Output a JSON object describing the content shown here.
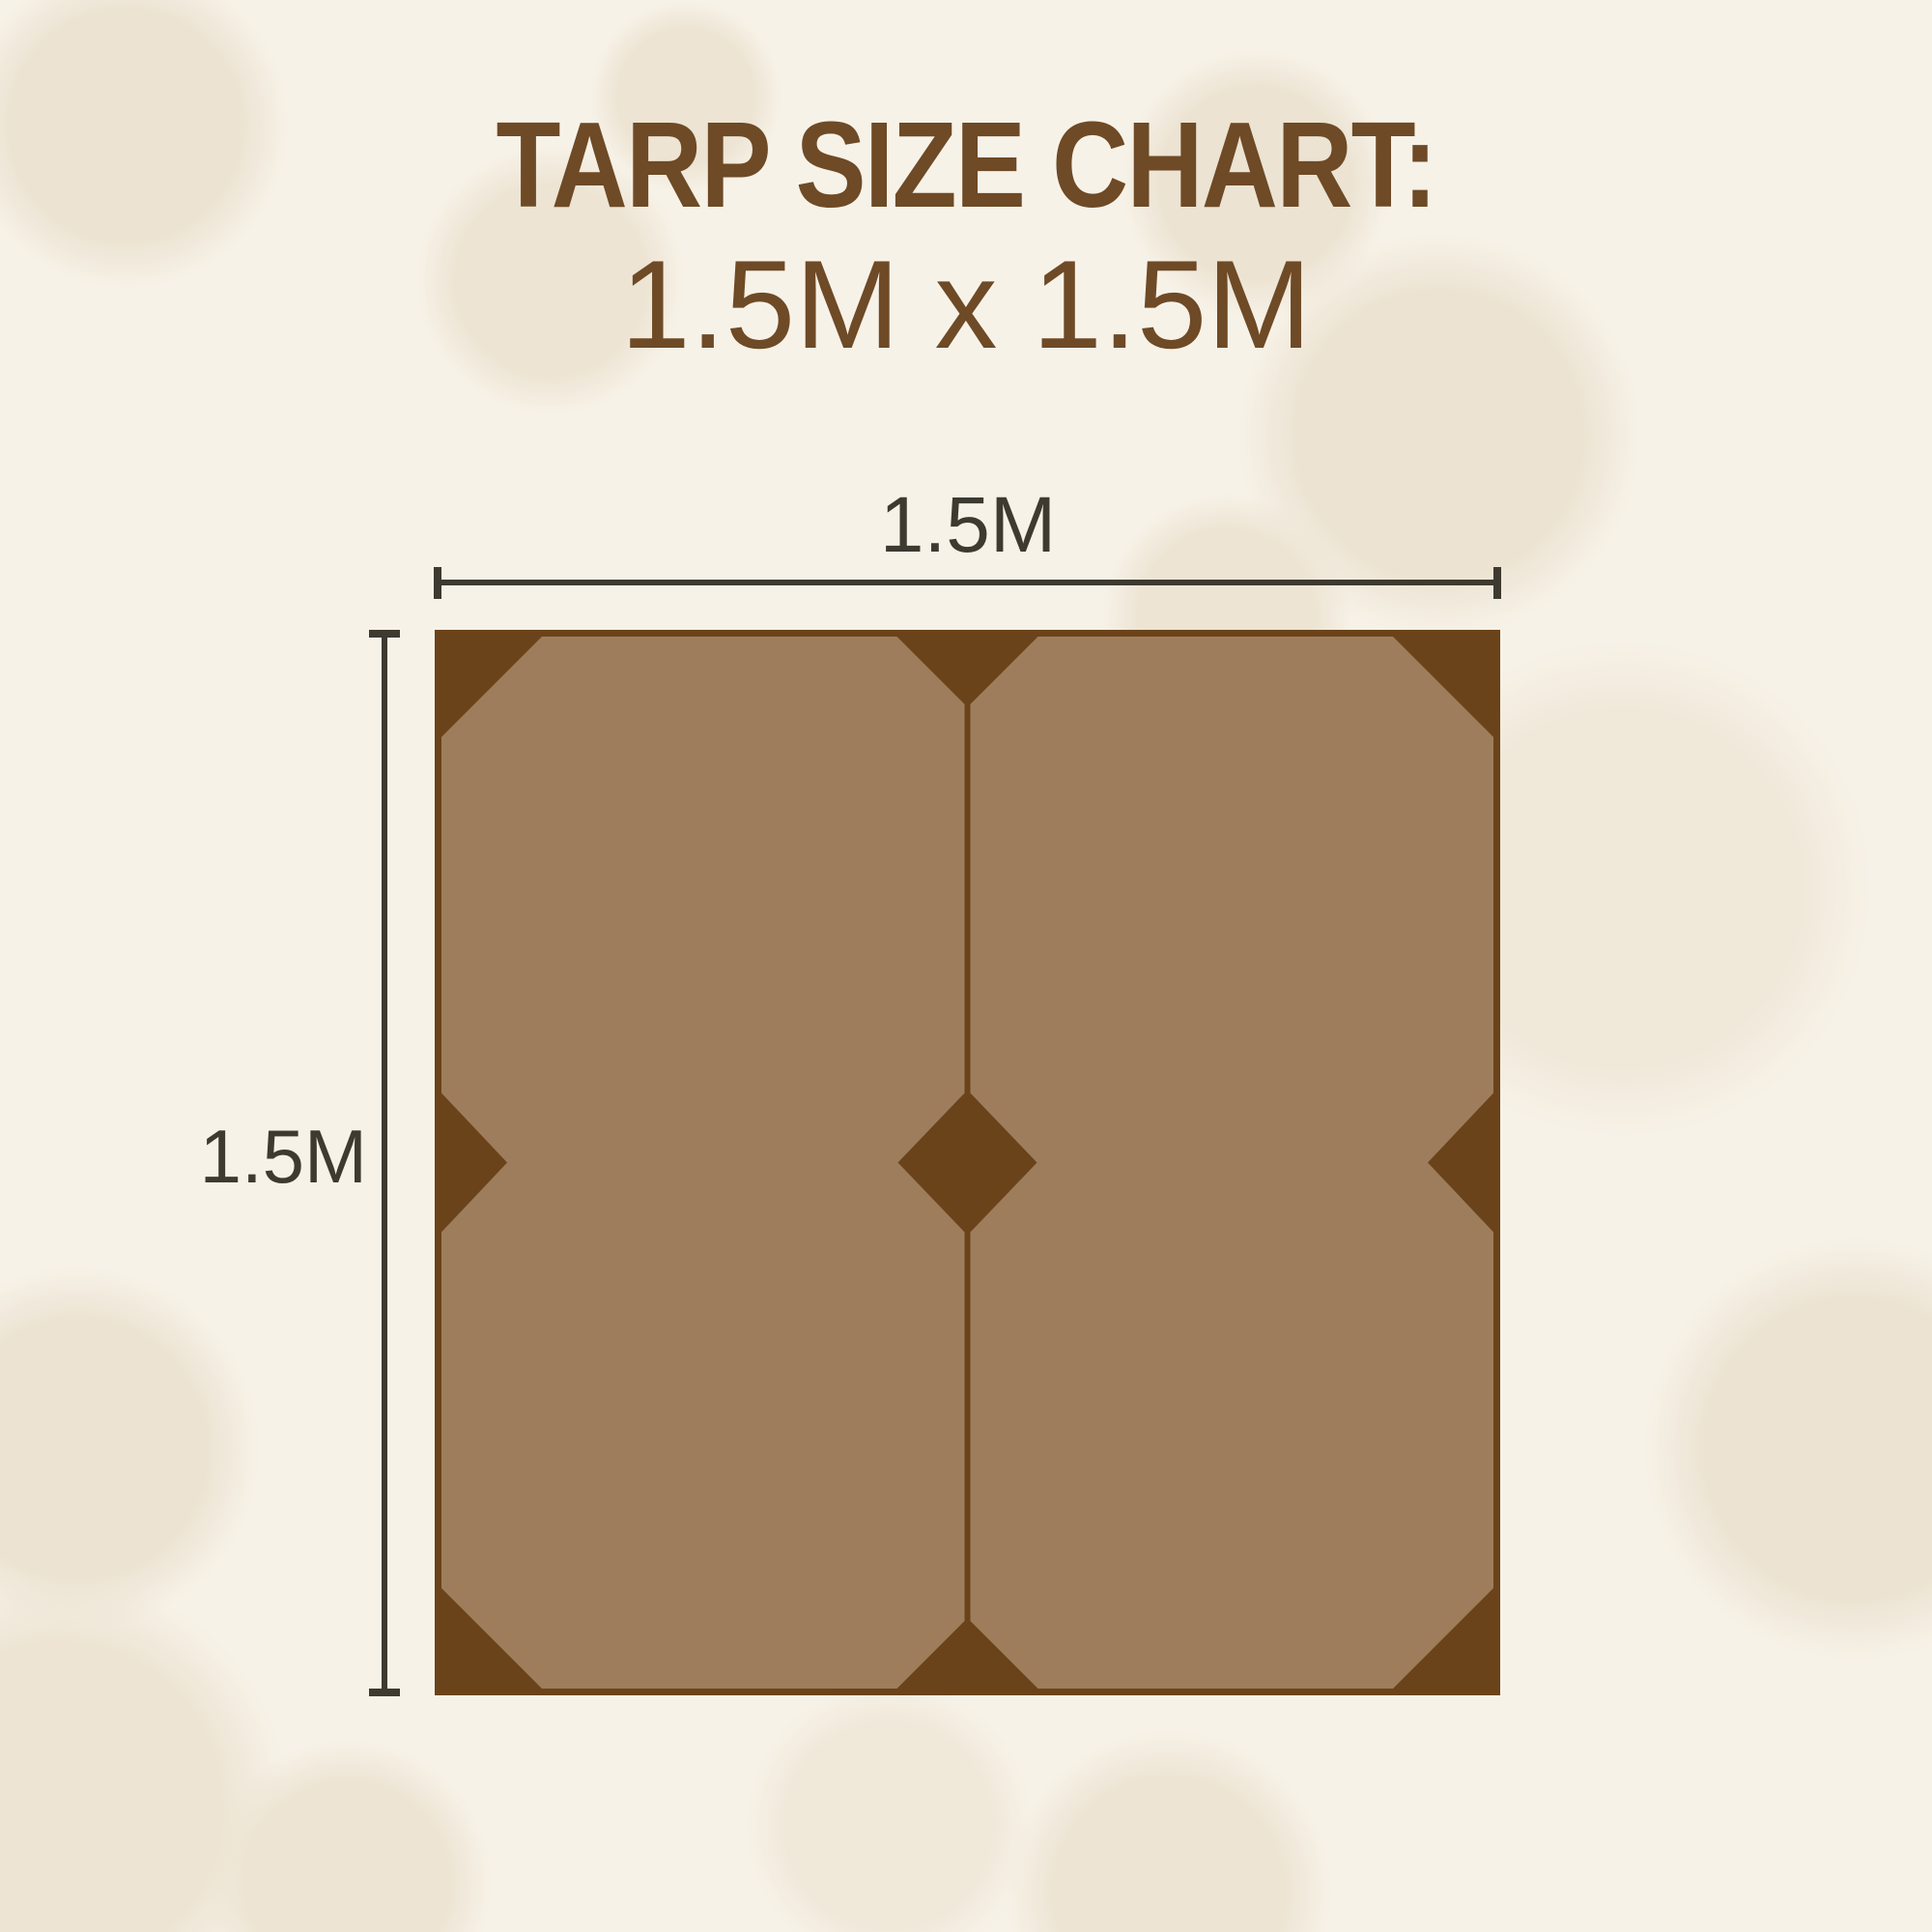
{
  "header": {
    "title": "TARP SIZE CHART:",
    "subtitle": "1.5M x 1.5M"
  },
  "diagram": {
    "type": "tarp-dimension-diagram",
    "width_label": "1.5M",
    "height_label": "1.5M",
    "panels": 2,
    "reinforcement_points": 9
  },
  "colors": {
    "background": "#f7f2e8",
    "background_blotch": "#ece3d2",
    "heading_text": "#6e4a26",
    "tarp_backing": "#6b431a",
    "tarp_panel": "#9e7d5d",
    "dimension_lines": "#3e3a30"
  }
}
